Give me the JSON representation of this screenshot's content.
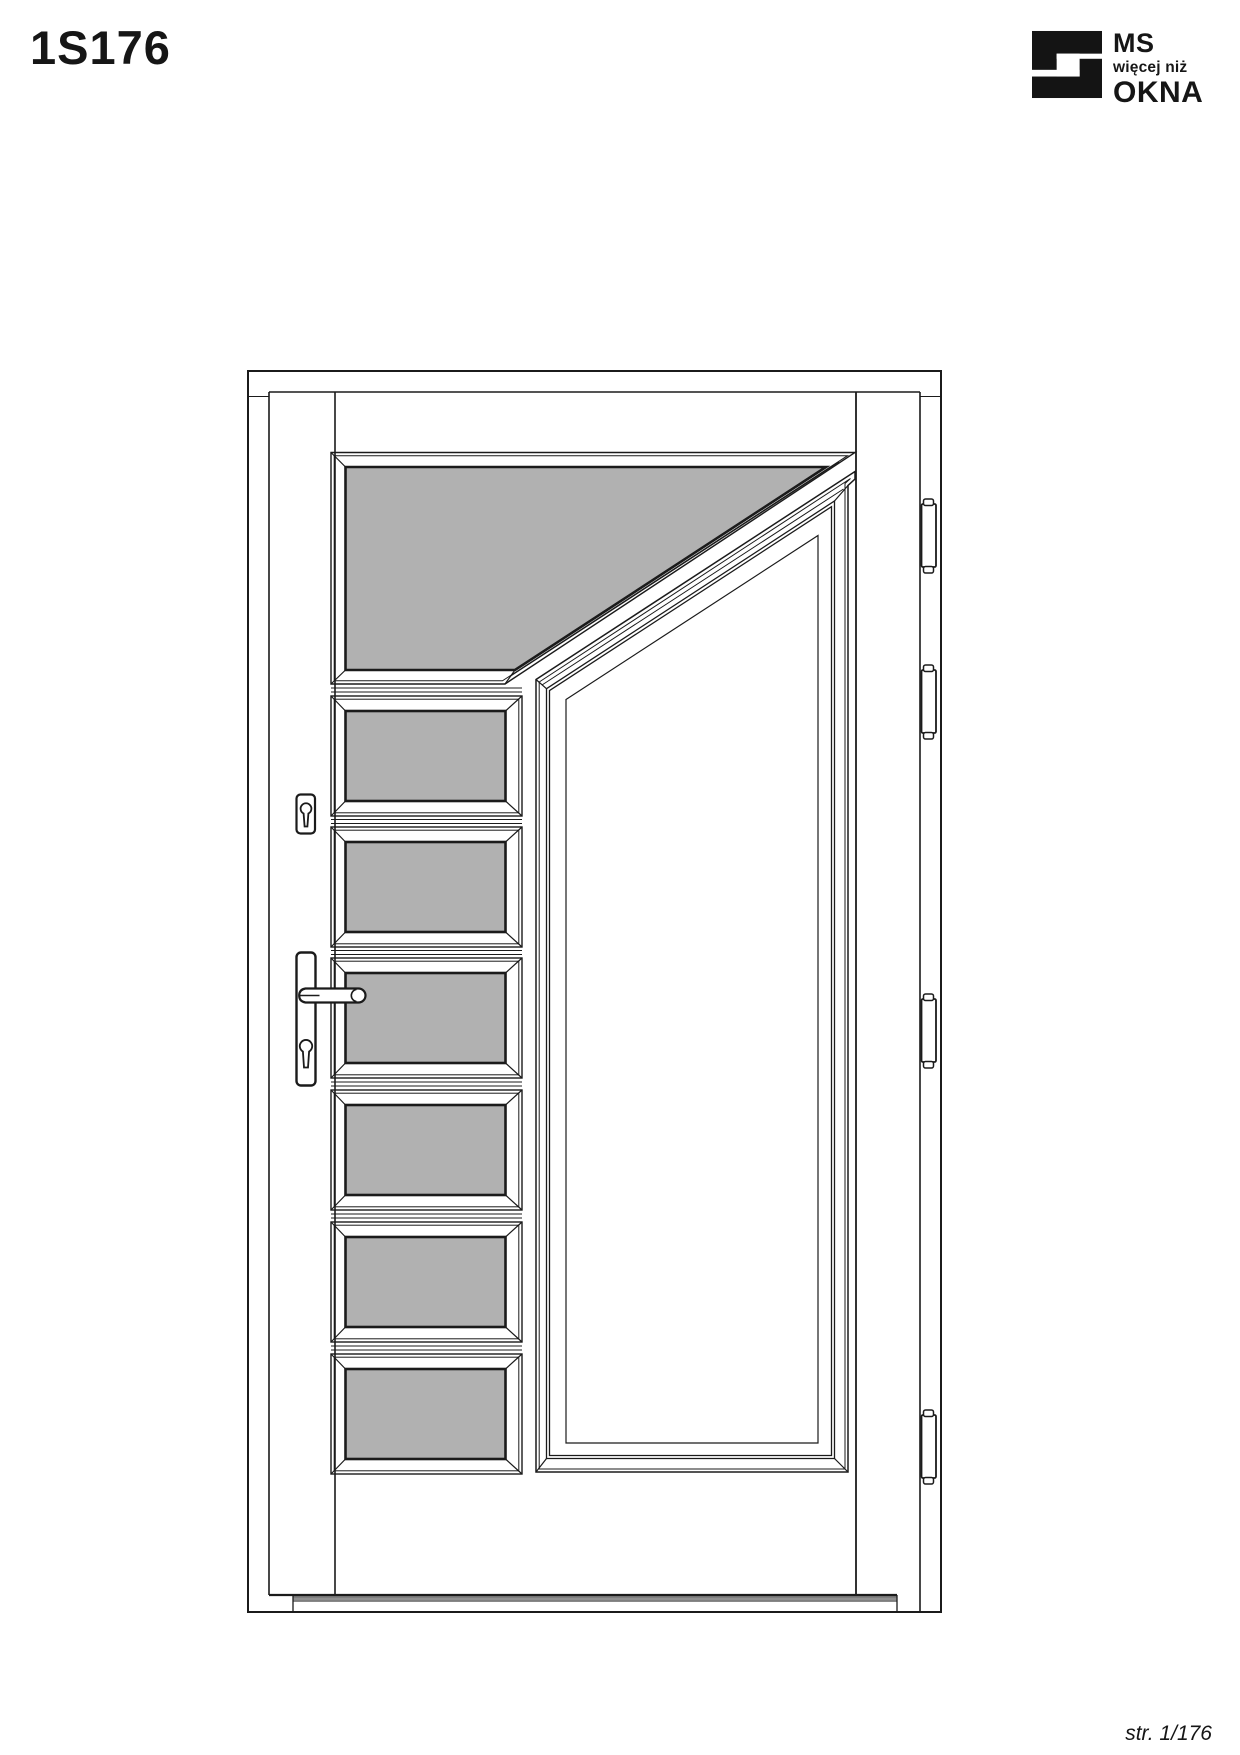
{
  "page": {
    "title": "1S176",
    "footer": "str. 1/176"
  },
  "logo": {
    "line1": "MS",
    "line2": "więcej niż",
    "line3": "OKNA"
  },
  "drawing": {
    "model": "1S176",
    "glass_panel_count": 7,
    "hinge_count": 4,
    "glass_color": "#b1b1b1",
    "line_color": "#1b1b1b",
    "threshold_seal_color": "#8f8f8f"
  }
}
